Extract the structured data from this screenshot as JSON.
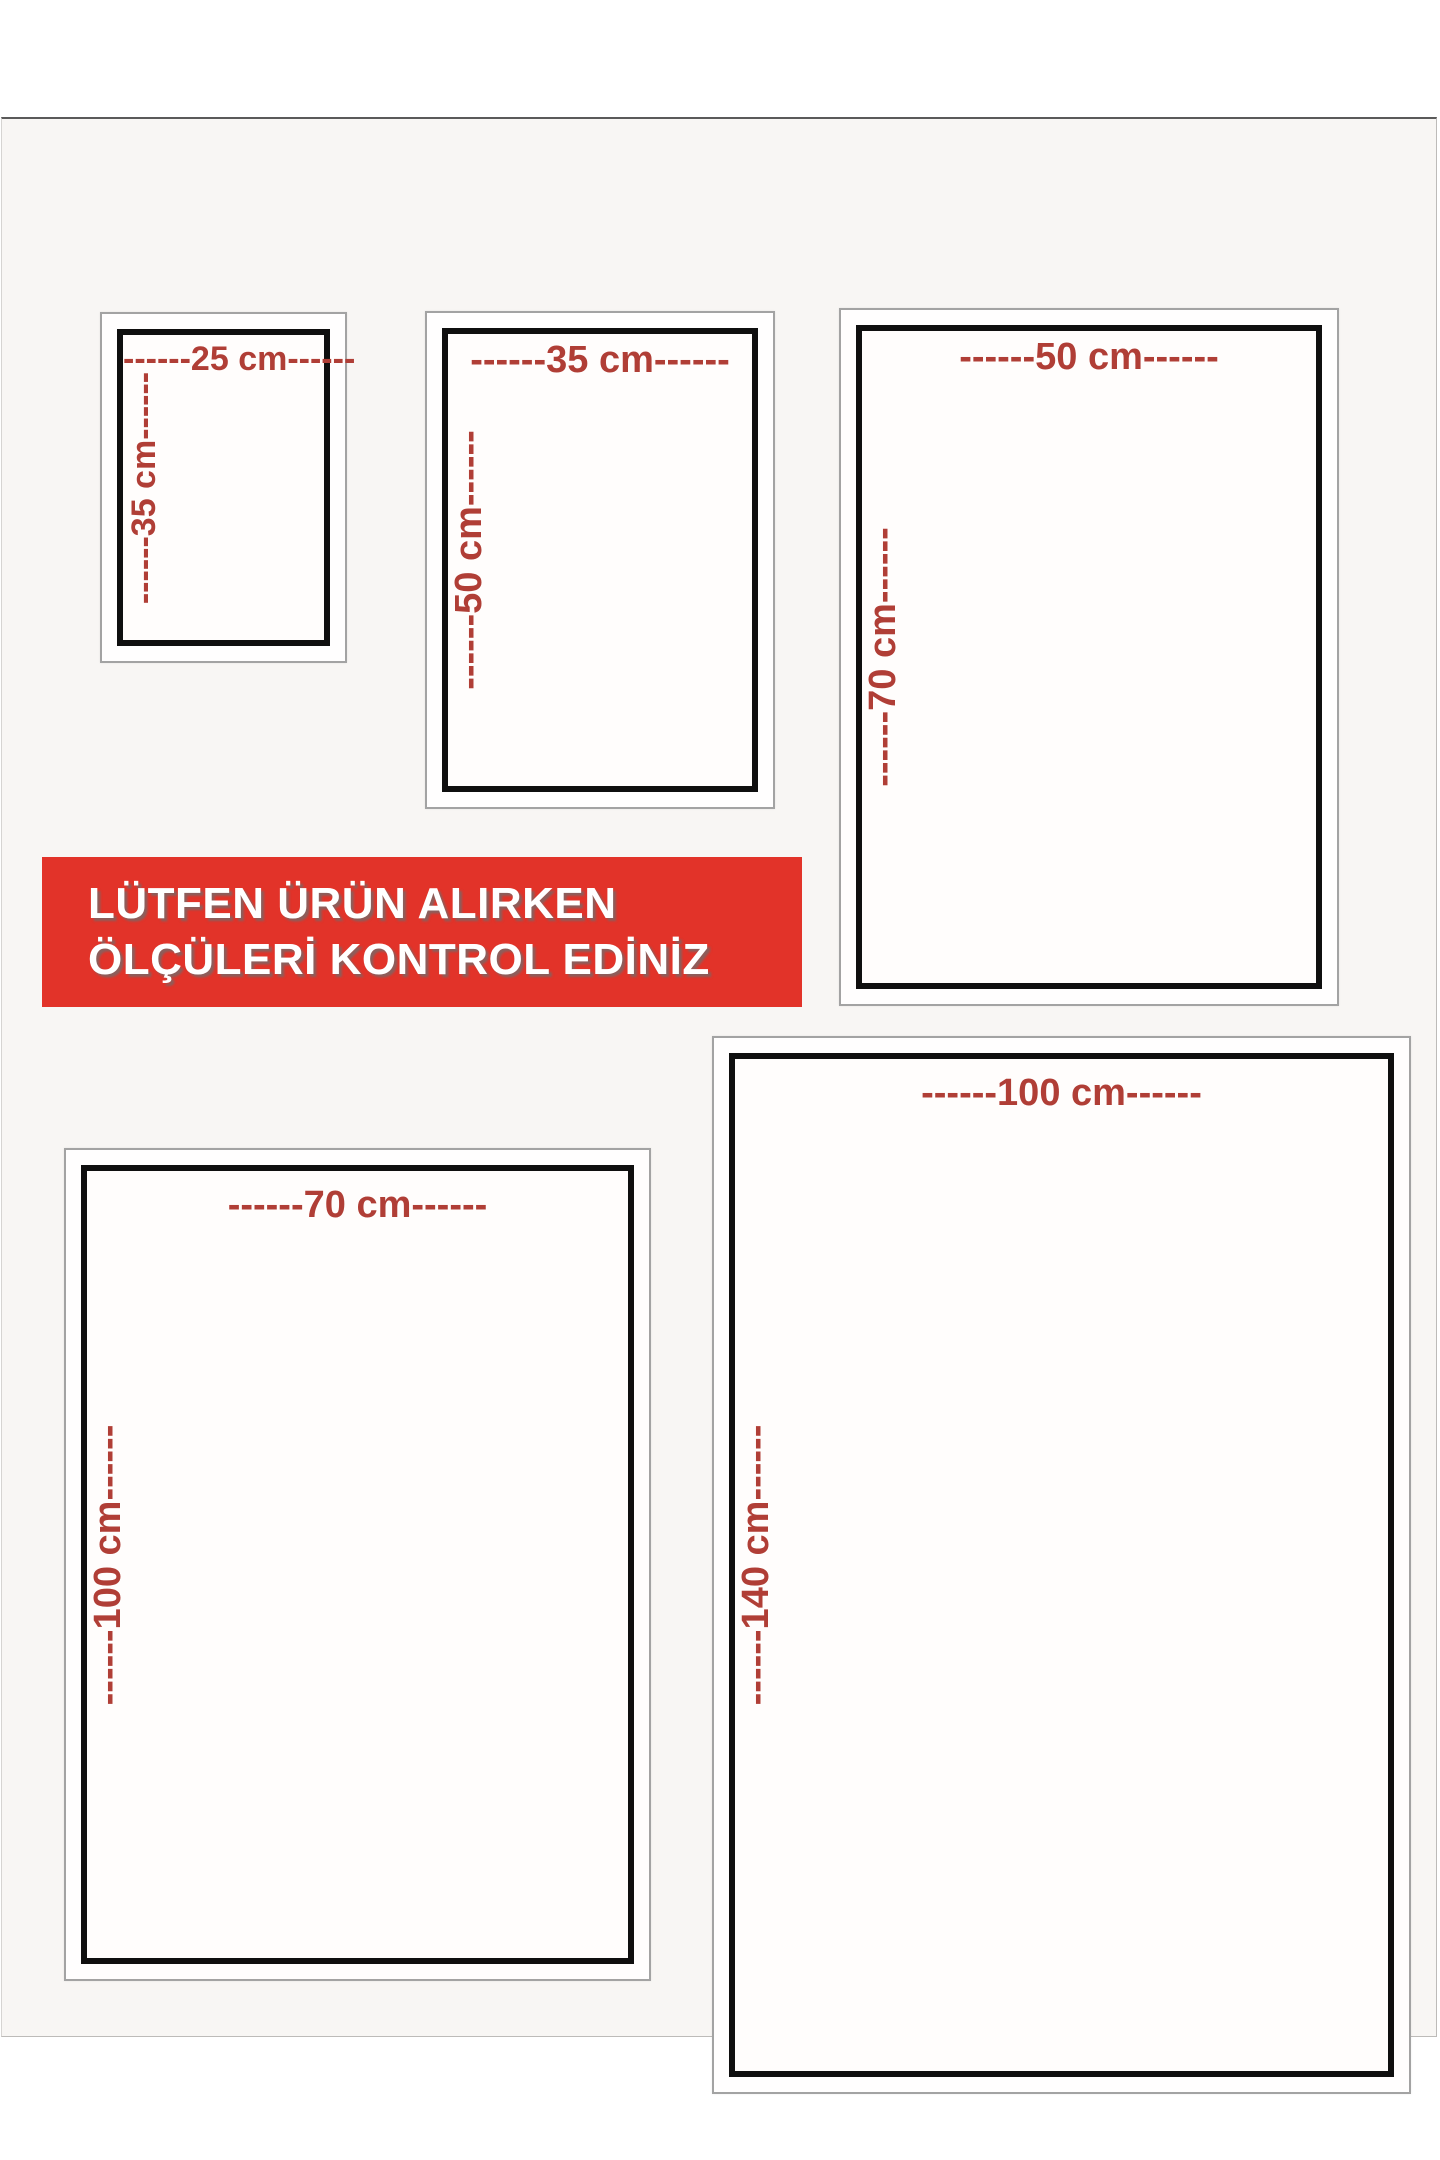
{
  "banner": {
    "line1": "LÜTFEN ÜRÜN ALIRKEN",
    "line2": "ÖLÇÜLERİ KONTROL EDİNİZ"
  },
  "frames": [
    {
      "size_name": "25x35 cm",
      "width_label": "------25 cm------",
      "height_label": "------35 cm------"
    },
    {
      "size_name": "35x50 cm",
      "width_label": "------35 cm------",
      "height_label": "------50 cm------"
    },
    {
      "size_name": "50x70 cm",
      "width_label": "------50 cm------",
      "height_label": "------70 cm------"
    },
    {
      "size_name": "70x100 cm",
      "width_label": "------70 cm------",
      "height_label": "------100 cm------"
    },
    {
      "size_name": "100x140 cm",
      "width_label": "------100 cm------",
      "height_label": "------140 cm------"
    }
  ],
  "colors": {
    "dimension_text": "#b03e36",
    "banner_red": "#e23329",
    "frame_border_black": "#0f0f0f",
    "frame_border_gray": "#a3a3a3",
    "photo_background": "#f8f6f4"
  }
}
